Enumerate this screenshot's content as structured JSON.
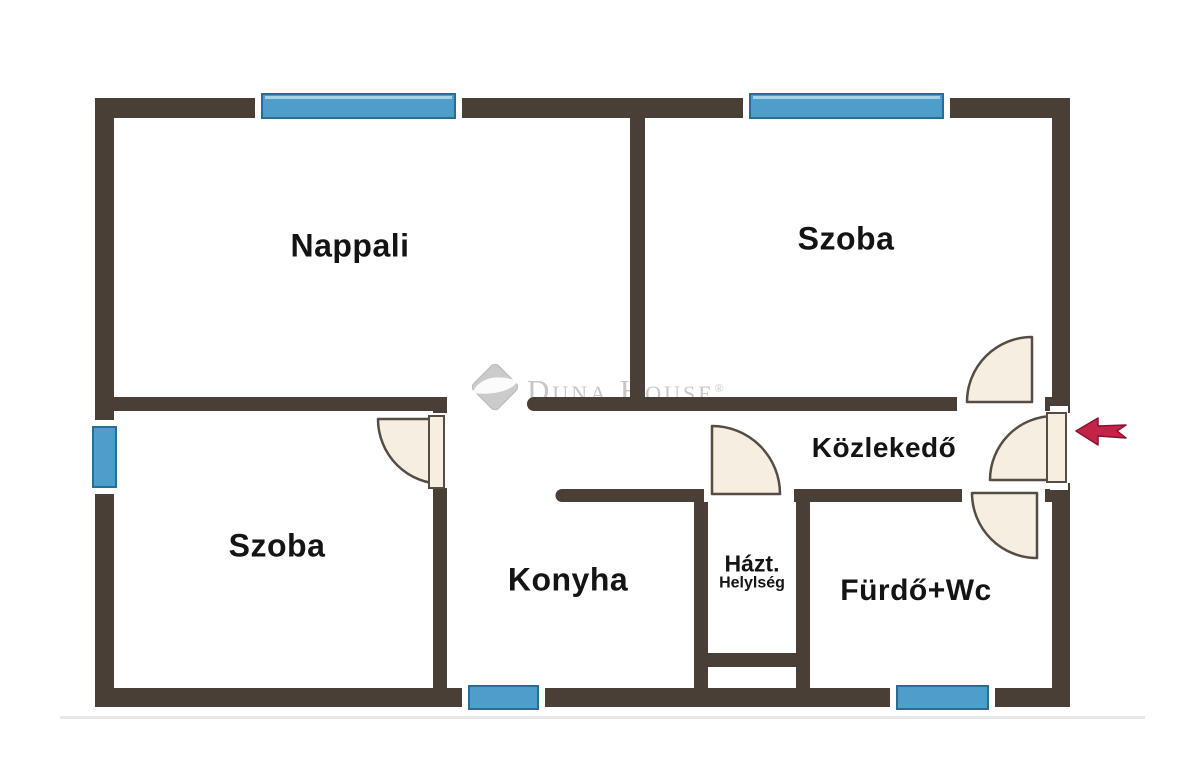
{
  "floorplan": {
    "brand": {
      "text": "Duna House",
      "registered": "®"
    },
    "rooms": [
      {
        "id": "nappali",
        "label": "Nappali"
      },
      {
        "id": "szoba-right",
        "label": "Szoba"
      },
      {
        "id": "szoba-left",
        "label": "Szoba"
      },
      {
        "id": "konyha",
        "label": "Konyha"
      },
      {
        "id": "hazt",
        "label": "Házt.",
        "label2": "Helylség"
      },
      {
        "id": "furdo-wc",
        "label": "Fürdő+Wc"
      },
      {
        "id": "kozlekedo",
        "label": "Közlekedő"
      }
    ],
    "colors": {
      "background": "#ffffff",
      "wall": "#493f36",
      "window": "#4f9dcb",
      "window_border": "#2a6d94",
      "door_fill": "#f6efe1",
      "door_stroke": "#554c44",
      "arrow": "#c42348",
      "arrow_stroke": "#8c1232",
      "logo_grey": "#c7c7c7",
      "diamond": "#cbcbcb",
      "label": "#141414",
      "faint_line": "#e8e8e8"
    }
  }
}
